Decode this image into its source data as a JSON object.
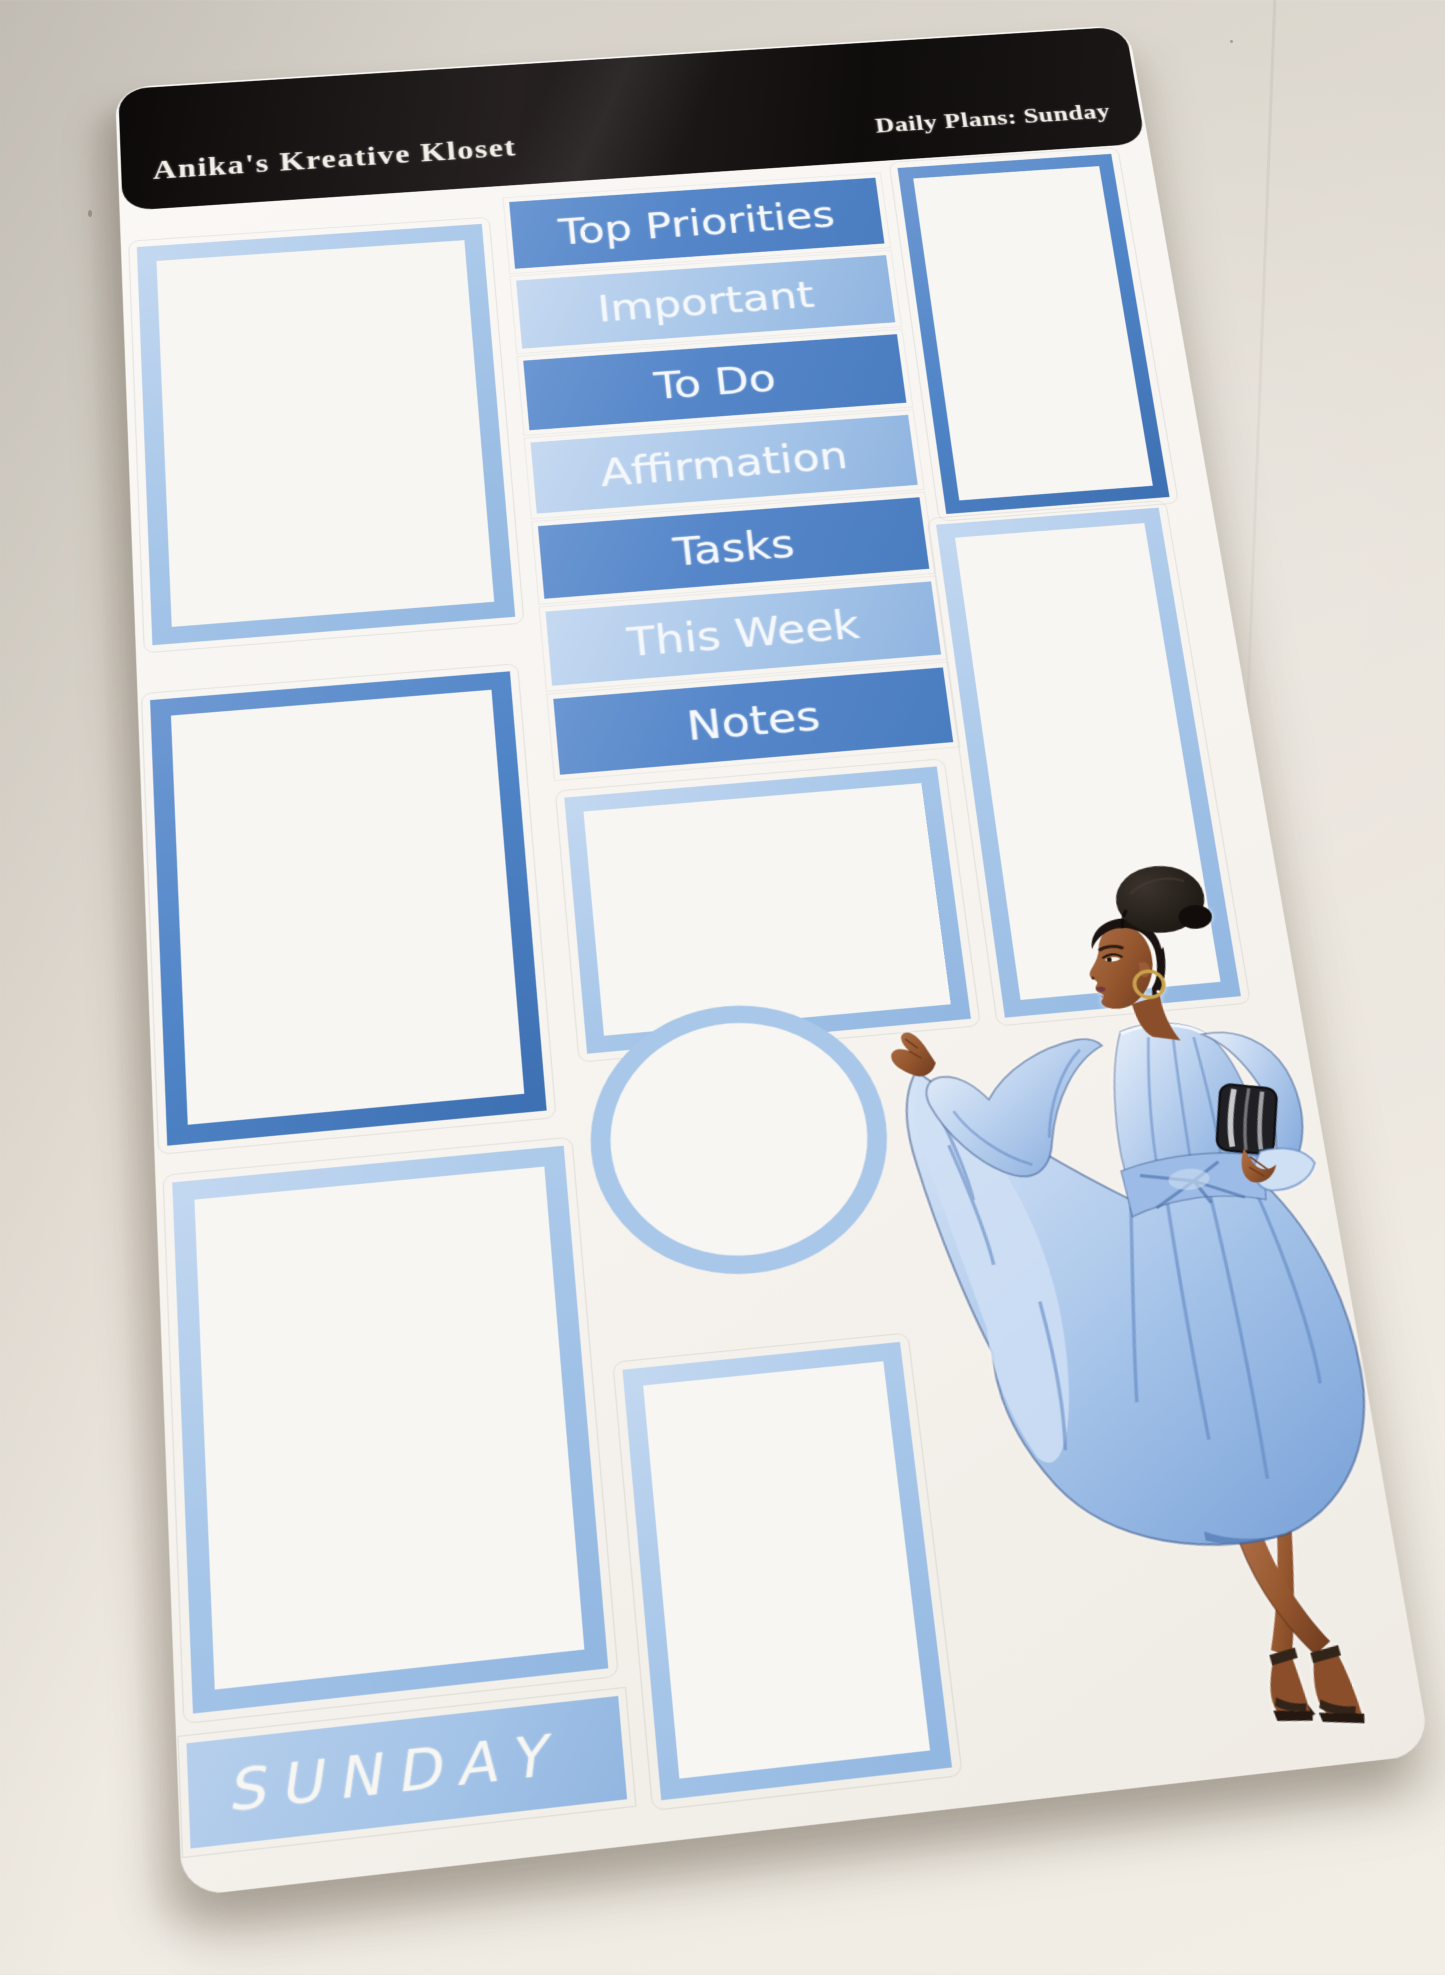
{
  "scene": {
    "description": "Photograph of a planner sticker sheet on a desk",
    "surface_color": "#e7e1d8"
  },
  "sheet": {
    "header": {
      "brand": "Anika's Kreative Kloset",
      "title": "Daily Plans: Sunday",
      "bar_color": "#14100e",
      "text_color": "#f2efe9"
    },
    "label_stickers": [
      {
        "label": "Top Priorities",
        "tone": "medium"
      },
      {
        "label": "Important",
        "tone": "light"
      },
      {
        "label": "To Do",
        "tone": "medium"
      },
      {
        "label": "Affirmation",
        "tone": "light"
      },
      {
        "label": "Tasks",
        "tone": "medium"
      },
      {
        "label": "This Week",
        "tone": "light"
      },
      {
        "label": "Notes",
        "tone": "medium"
      }
    ],
    "day_sticker": {
      "label": "SUNDAY",
      "tone": "light"
    },
    "box_stickers": [
      {
        "name": "left-box-1",
        "border": "light"
      },
      {
        "name": "left-box-2",
        "border": "medium"
      },
      {
        "name": "left-box-3",
        "border": "light"
      },
      {
        "name": "middle-box",
        "border": "light"
      },
      {
        "name": "circle-frame",
        "border": "light"
      },
      {
        "name": "middle-tall-box",
        "border": "light"
      },
      {
        "name": "right-box-1",
        "border": "medium"
      },
      {
        "name": "right-box-2",
        "border": "light"
      }
    ],
    "colors": {
      "medium_blue": "#5286c8",
      "light_blue": "#a9c7e9",
      "paper": "#f8f6f2"
    },
    "illustration": {
      "name": "woman-in-blue-dress",
      "skin": "#96582f",
      "dress": "#a8c6ec",
      "hair": "#1a1310",
      "shoes": "#33241a",
      "accessories": "gold hoop earring, silver clutch"
    }
  }
}
